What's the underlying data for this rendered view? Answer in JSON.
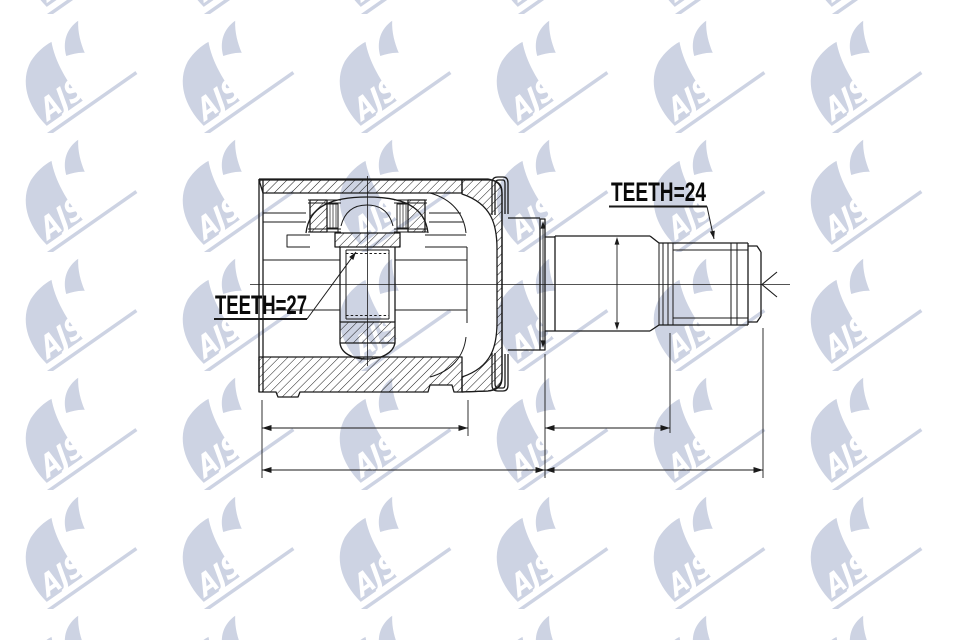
{
  "page": {
    "background": "#ffffff"
  },
  "watermark": {
    "text_ajs": "AJS",
    "text_parts": "PARTS",
    "color": "#cdd3e3",
    "outline_color": "#c6cddf"
  },
  "labels": {
    "teeth_left": "TEETH=27",
    "teeth_right": "TEETH=24"
  },
  "drawing": {
    "line_color": "#1a1a1a",
    "label_color": "#0a0a0a"
  }
}
